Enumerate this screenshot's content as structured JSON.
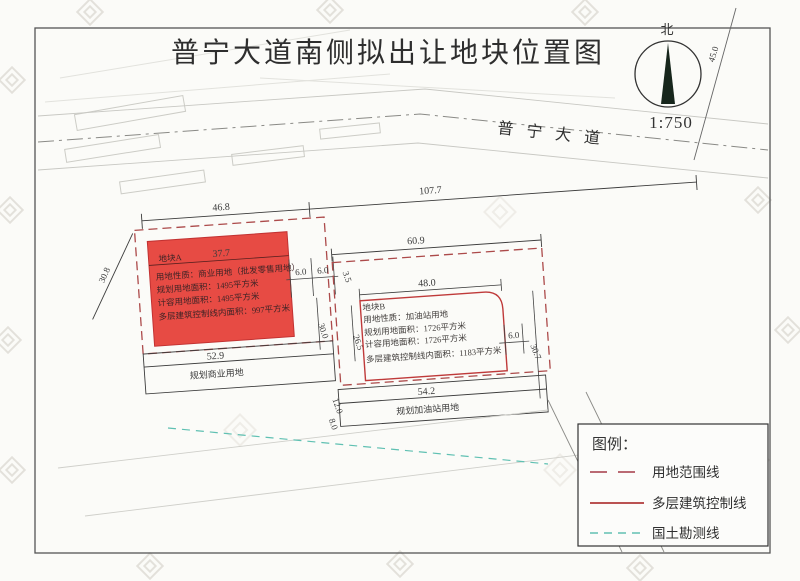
{
  "title": "普宁大道南侧拟出让地块位置图",
  "map": {
    "road_label": "普宁大道",
    "north_label": "北",
    "scale_label": "1:750",
    "plot_a": {
      "name": "地块A",
      "info": [
        "用地性质：商业用地（批发零售用地）",
        "规划用地面积：1495平方米",
        "计容用地面积：1495平方米",
        "多层建筑控制线内面积：997平方米"
      ]
    },
    "plot_b": {
      "name": "地块B",
      "info": [
        "用地性质：加油站用地",
        "规划用地面积：1726平方米",
        "计容用地面积：1726平方米",
        "多层建筑控制线内面积：1183平方米"
      ]
    },
    "zones": {
      "commercial": "规划商业用地",
      "gas_station": "规划加油站用地"
    },
    "dims": {
      "a_top": "46.8",
      "road_top": "107.7",
      "b_top": "60.9",
      "a_width": "37.7",
      "a_left": "30.8",
      "a_bottom": "52.9",
      "a_gap1": "6.0",
      "a_gap2": "6.0",
      "a_height": "30.0",
      "b_left": "26.5",
      "b_top_offset": "3.5",
      "b_width": "48.0",
      "b_gap": "6.0",
      "b_right": "30.7",
      "gas_left_top": "12.0",
      "gas_left_bottom": "8.0",
      "gas_width": "54.2",
      "avenue_width": "45.0"
    }
  },
  "legend": {
    "title": "图例：",
    "items": [
      {
        "label": "用地范围线",
        "style": "dashed-red"
      },
      {
        "label": "多层建筑控制线",
        "style": "solid-red"
      },
      {
        "label": "国土勘测线",
        "style": "dashed-teal"
      }
    ]
  },
  "icons": {
    "north_needle": "compass-needle",
    "watermark": "diamond-logo-watermark"
  },
  "colors": {
    "plot_fill": "#e6413a",
    "boundary_line": "#ac4a4a",
    "control_line": "#bf3a3a",
    "survey_line": "#5fc0b2",
    "ink": "#333333",
    "paper": "#fbfbf8"
  }
}
